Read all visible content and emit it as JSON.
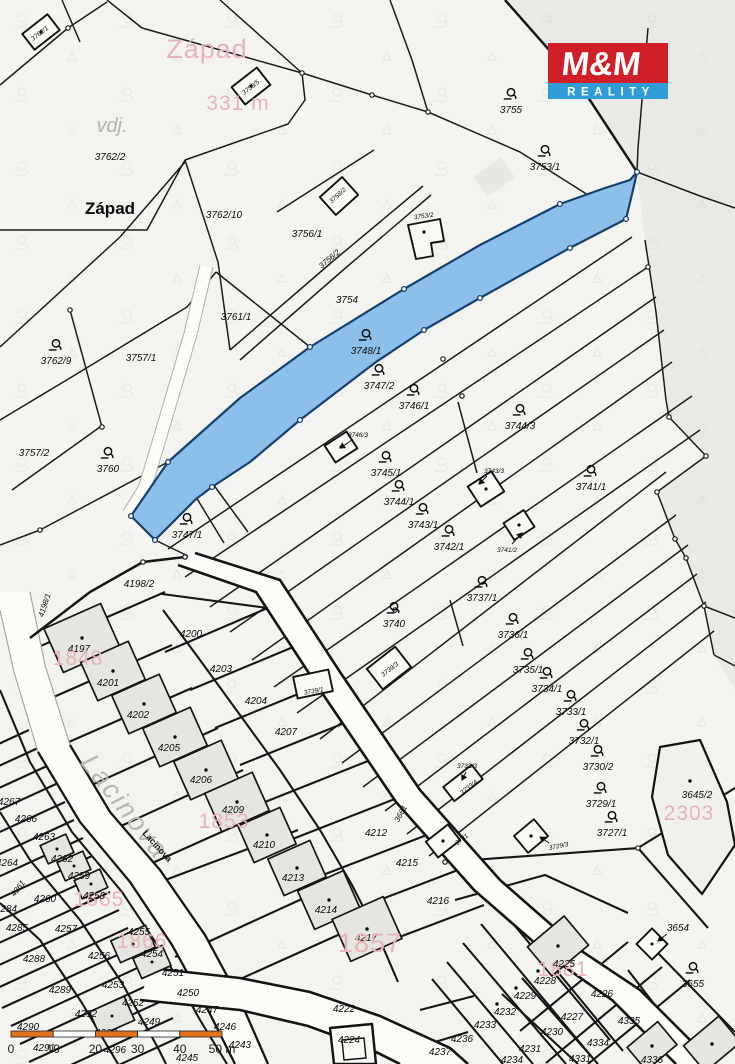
{
  "branding": {
    "logo_top": "M&M",
    "logo_bottom": "REALITY",
    "logo_red": "#d01f26",
    "logo_blue": "#2f9cd7"
  },
  "highlight": {
    "parcel": "3748/1",
    "fill": "#8cbfe9",
    "stroke": "#15416d"
  },
  "scale_bar": {
    "labels": [
      "0",
      "10",
      "20",
      "30",
      "40",
      "50 m"
    ],
    "bar_color": "#e2711c"
  },
  "labels": [
    {
      "t": "3762/1",
      "x": 41,
      "y": 35,
      "c": "xs",
      "r": -38
    },
    {
      "t": "3753/5",
      "x": 252,
      "y": 89,
      "c": "xs",
      "r": -38
    },
    {
      "t": "Západ",
      "x": 207,
      "y": 58,
      "c": "pinklg"
    },
    {
      "t": "331 m",
      "x": 238,
      "y": 110,
      "c": "pink"
    },
    {
      "t": "vdj.",
      "x": 112,
      "y": 132,
      "c": "graymd"
    },
    {
      "t": "3762/2",
      "x": 110,
      "y": 160,
      "c": "std"
    },
    {
      "t": "Západ",
      "x": 110,
      "y": 214,
      "c": "blk"
    },
    {
      "t": "3762/10",
      "x": 224,
      "y": 218,
      "c": "std"
    },
    {
      "t": "3756/1",
      "x": 307,
      "y": 237,
      "c": "std"
    },
    {
      "t": "3758/2",
      "x": 339,
      "y": 197,
      "c": "xs",
      "r": -42
    },
    {
      "t": "3753/2",
      "x": 424,
      "y": 218,
      "c": "xs",
      "r": -8
    },
    {
      "t": "3755",
      "x": 511,
      "y": 113,
      "c": "std",
      "sym": 1
    },
    {
      "t": "3753/1",
      "x": 545,
      "y": 170,
      "c": "std",
      "sym": 1
    },
    {
      "t": "3756/2",
      "x": 331,
      "y": 261,
      "c": "sm",
      "r": -40
    },
    {
      "t": "3754",
      "x": 347,
      "y": 303,
      "c": "std"
    },
    {
      "t": "3761/1",
      "x": 236,
      "y": 320,
      "c": "std"
    },
    {
      "t": "3748/1",
      "x": 366,
      "y": 354,
      "c": "std",
      "sym": 1
    },
    {
      "t": "3762/9",
      "x": 56,
      "y": 364,
      "c": "std",
      "sym": 1
    },
    {
      "t": "3757/1",
      "x": 141,
      "y": 361,
      "c": "std"
    },
    {
      "t": "3757/2",
      "x": 34,
      "y": 456,
      "c": "std"
    },
    {
      "t": "3760",
      "x": 108,
      "y": 472,
      "c": "std",
      "sym": 1
    },
    {
      "t": "3747/1",
      "x": 187,
      "y": 538,
      "c": "std",
      "sym": 1
    },
    {
      "t": "3747/2",
      "x": 379,
      "y": 389,
      "c": "std",
      "sym": 1
    },
    {
      "t": "3746/1",
      "x": 414,
      "y": 409,
      "c": "std",
      "sym": 1
    },
    {
      "t": "3744/3",
      "x": 520,
      "y": 429,
      "c": "std",
      "sym": 1
    },
    {
      "t": "3746/3",
      "x": 358,
      "y": 437,
      "c": "xs"
    },
    {
      "t": "3745/1",
      "x": 386,
      "y": 476,
      "c": "std",
      "sym": 1
    },
    {
      "t": "3743/3",
      "x": 494,
      "y": 473,
      "c": "xs"
    },
    {
      "t": "3744/1",
      "x": 399,
      "y": 505,
      "c": "std",
      "sym": 1
    },
    {
      "t": "3741/1",
      "x": 591,
      "y": 490,
      "c": "std",
      "sym": 1
    },
    {
      "t": "3743/1",
      "x": 423,
      "y": 528,
      "c": "std",
      "sym": 1
    },
    {
      "t": "3742/1",
      "x": 449,
      "y": 550,
      "c": "std",
      "sym": 1
    },
    {
      "t": "3741/2",
      "x": 507,
      "y": 552,
      "c": "xs"
    },
    {
      "t": "3737/1",
      "x": 482,
      "y": 601,
      "c": "std",
      "sym": 1
    },
    {
      "t": "3740",
      "x": 394,
      "y": 627,
      "c": "std",
      "sym": 1
    },
    {
      "t": "3736/1",
      "x": 513,
      "y": 638,
      "c": "std",
      "sym": 1
    },
    {
      "t": "3739/1",
      "x": 314,
      "y": 693,
      "c": "xs",
      "r": -10
    },
    {
      "t": "3739/3",
      "x": 391,
      "y": 671,
      "c": "xs",
      "r": -38
    },
    {
      "t": "3735/1",
      "x": 528,
      "y": 673,
      "c": "std",
      "sym": 1
    },
    {
      "t": "3734/1",
      "x": 547,
      "y": 692,
      "c": "std",
      "sym": 1
    },
    {
      "t": "3733/1",
      "x": 571,
      "y": 715,
      "c": "std",
      "sym": 1
    },
    {
      "t": "3732/1",
      "x": 584,
      "y": 744,
      "c": "std",
      "sym": 1
    },
    {
      "t": "3730/2",
      "x": 598,
      "y": 770,
      "c": "std",
      "sym": 1
    },
    {
      "t": "3733/3",
      "x": 467,
      "y": 768,
      "c": "xs"
    },
    {
      "t": "3733/4",
      "x": 470,
      "y": 789,
      "c": "xs",
      "r": -38
    },
    {
      "t": "3729/1",
      "x": 601,
      "y": 807,
      "c": "std",
      "sym": 1
    },
    {
      "t": "3727/1",
      "x": 612,
      "y": 836,
      "c": "std",
      "sym": 1
    },
    {
      "t": "3731",
      "x": 463,
      "y": 841,
      "c": "xs",
      "r": -38
    },
    {
      "t": "3729/3",
      "x": 559,
      "y": 848,
      "c": "xs",
      "r": -12
    },
    {
      "t": "3645/2",
      "x": 697,
      "y": 798,
      "c": "std"
    },
    {
      "t": "2303",
      "x": 689,
      "y": 820,
      "c": "pink"
    },
    {
      "t": "3654",
      "x": 678,
      "y": 931,
      "c": "std"
    },
    {
      "t": "3655",
      "x": 693,
      "y": 987,
      "c": "std",
      "sym": 1
    },
    {
      "t": "3661",
      "x": 403,
      "y": 815,
      "c": "sm",
      "r": -60
    },
    {
      "t": "4198/1",
      "x": 47,
      "y": 606,
      "c": "sm",
      "r": -72
    },
    {
      "t": "4198/2",
      "x": 139,
      "y": 587,
      "c": "std"
    },
    {
      "t": "4197",
      "x": 79,
      "y": 652,
      "c": "std"
    },
    {
      "t": "4200",
      "x": 191,
      "y": 637,
      "c": "std"
    },
    {
      "t": "4201",
      "x": 108,
      "y": 686,
      "c": "std"
    },
    {
      "t": "4203",
      "x": 221,
      "y": 672,
      "c": "std"
    },
    {
      "t": "4202",
      "x": 138,
      "y": 718,
      "c": "std"
    },
    {
      "t": "4204",
      "x": 256,
      "y": 704,
      "c": "std"
    },
    {
      "t": "4205",
      "x": 169,
      "y": 751,
      "c": "std"
    },
    {
      "t": "4207",
      "x": 286,
      "y": 735,
      "c": "std"
    },
    {
      "t": "4206",
      "x": 201,
      "y": 783,
      "c": "std"
    },
    {
      "t": "4209",
      "x": 233,
      "y": 813,
      "c": "std"
    },
    {
      "t": "4210",
      "x": 264,
      "y": 848,
      "c": "std"
    },
    {
      "t": "4212",
      "x": 376,
      "y": 836,
      "c": "std"
    },
    {
      "t": "4213",
      "x": 293,
      "y": 881,
      "c": "std"
    },
    {
      "t": "4215",
      "x": 407,
      "y": 866,
      "c": "std"
    },
    {
      "t": "4214",
      "x": 326,
      "y": 913,
      "c": "std"
    },
    {
      "t": "4216",
      "x": 438,
      "y": 904,
      "c": "std"
    },
    {
      "t": "4217",
      "x": 366,
      "y": 941,
      "c": "std"
    },
    {
      "t": "4222",
      "x": 344,
      "y": 1012,
      "c": "std"
    },
    {
      "t": "4224",
      "x": 349,
      "y": 1043,
      "c": "std"
    },
    {
      "t": "1848",
      "x": 78,
      "y": 665,
      "c": "pink"
    },
    {
      "t": "1853",
      "x": 224,
      "y": 828,
      "c": "pink"
    },
    {
      "t": "1865",
      "x": 99,
      "y": 906,
      "c": "pink"
    },
    {
      "t": "1866",
      "x": 142,
      "y": 948,
      "c": "pink"
    },
    {
      "t": "1857",
      "x": 370,
      "y": 952,
      "c": "pinklg"
    },
    {
      "t": "1881",
      "x": 563,
      "y": 976,
      "c": "pink"
    },
    {
      "t": "Lacinova",
      "x": 118,
      "y": 812,
      "c": "graybig",
      "r": 52
    },
    {
      "t": "Lacinova",
      "x": 155,
      "y": 848,
      "c": "lacsm",
      "r": 48
    },
    {
      "t": "4267",
      "x": 9,
      "y": 805,
      "c": "std"
    },
    {
      "t": "4266",
      "x": 26,
      "y": 822,
      "c": "std"
    },
    {
      "t": "4263",
      "x": 44,
      "y": 840,
      "c": "std"
    },
    {
      "t": "4264",
      "x": 7,
      "y": 866,
      "c": "std"
    },
    {
      "t": "4262",
      "x": 62,
      "y": 862,
      "c": "std"
    },
    {
      "t": "4259",
      "x": 79,
      "y": 879,
      "c": "std"
    },
    {
      "t": "4261",
      "x": 20,
      "y": 890,
      "c": "sm",
      "r": -52
    },
    {
      "t": "4260",
      "x": 45,
      "y": 902,
      "c": "std"
    },
    {
      "t": "4258",
      "x": 94,
      "y": 899,
      "c": "std"
    },
    {
      "t": "4284",
      "x": 6,
      "y": 912,
      "c": "std"
    },
    {
      "t": "4285",
      "x": 17,
      "y": 931,
      "c": "std"
    },
    {
      "t": "4257",
      "x": 66,
      "y": 932,
      "c": "std"
    },
    {
      "t": "4255",
      "x": 139,
      "y": 935,
      "c": "std"
    },
    {
      "t": "4288",
      "x": 34,
      "y": 962,
      "c": "std"
    },
    {
      "t": "4256",
      "x": 99,
      "y": 959,
      "c": "std"
    },
    {
      "t": "4254",
      "x": 152,
      "y": 957,
      "c": "std"
    },
    {
      "t": "4251",
      "x": 173,
      "y": 976,
      "c": "std"
    },
    {
      "t": "4253",
      "x": 113,
      "y": 988,
      "c": "std"
    },
    {
      "t": "4289",
      "x": 60,
      "y": 993,
      "c": "std"
    },
    {
      "t": "4250",
      "x": 188,
      "y": 996,
      "c": "std"
    },
    {
      "t": "4252",
      "x": 133,
      "y": 1006,
      "c": "std"
    },
    {
      "t": "4292",
      "x": 86,
      "y": 1017,
      "c": "std"
    },
    {
      "t": "4247",
      "x": 207,
      "y": 1013,
      "c": "std"
    },
    {
      "t": "4290",
      "x": 28,
      "y": 1030,
      "c": "std"
    },
    {
      "t": "4249",
      "x": 149,
      "y": 1025,
      "c": "std"
    },
    {
      "t": "4246",
      "x": 225,
      "y": 1030,
      "c": "std"
    },
    {
      "t": "4293",
      "x": 106,
      "y": 1036,
      "c": "std"
    },
    {
      "t": "4291",
      "x": 44,
      "y": 1051,
      "c": "std"
    },
    {
      "t": "4296",
      "x": 115,
      "y": 1053,
      "c": "std"
    },
    {
      "t": "4243",
      "x": 240,
      "y": 1048,
      "c": "std"
    },
    {
      "t": "4245",
      "x": 187,
      "y": 1061,
      "c": "std"
    },
    {
      "t": "4225",
      "x": 564,
      "y": 967,
      "c": "std"
    },
    {
      "t": "4228",
      "x": 545,
      "y": 984,
      "c": "std"
    },
    {
      "t": "4229",
      "x": 525,
      "y": 999,
      "c": "std"
    },
    {
      "t": "4232",
      "x": 505,
      "y": 1015,
      "c": "std"
    },
    {
      "t": "4233",
      "x": 485,
      "y": 1028,
      "c": "std"
    },
    {
      "t": "4226",
      "x": 602,
      "y": 997,
      "c": "std"
    },
    {
      "t": "4227",
      "x": 572,
      "y": 1020,
      "c": "std"
    },
    {
      "t": "4230",
      "x": 552,
      "y": 1035,
      "c": "std"
    },
    {
      "t": "4231",
      "x": 530,
      "y": 1052,
      "c": "std"
    },
    {
      "t": "4234",
      "x": 512,
      "y": 1063,
      "c": "std"
    },
    {
      "t": "4335",
      "x": 629,
      "y": 1024,
      "c": "std"
    },
    {
      "t": "4334",
      "x": 598,
      "y": 1046,
      "c": "std"
    },
    {
      "t": "4331",
      "x": 580,
      "y": 1062,
      "c": "std"
    },
    {
      "t": "4336",
      "x": 652,
      "y": 1063,
      "c": "std"
    },
    {
      "t": "4236",
      "x": 462,
      "y": 1042,
      "c": "std"
    },
    {
      "t": "4237",
      "x": 440,
      "y": 1055,
      "c": "std"
    }
  ]
}
